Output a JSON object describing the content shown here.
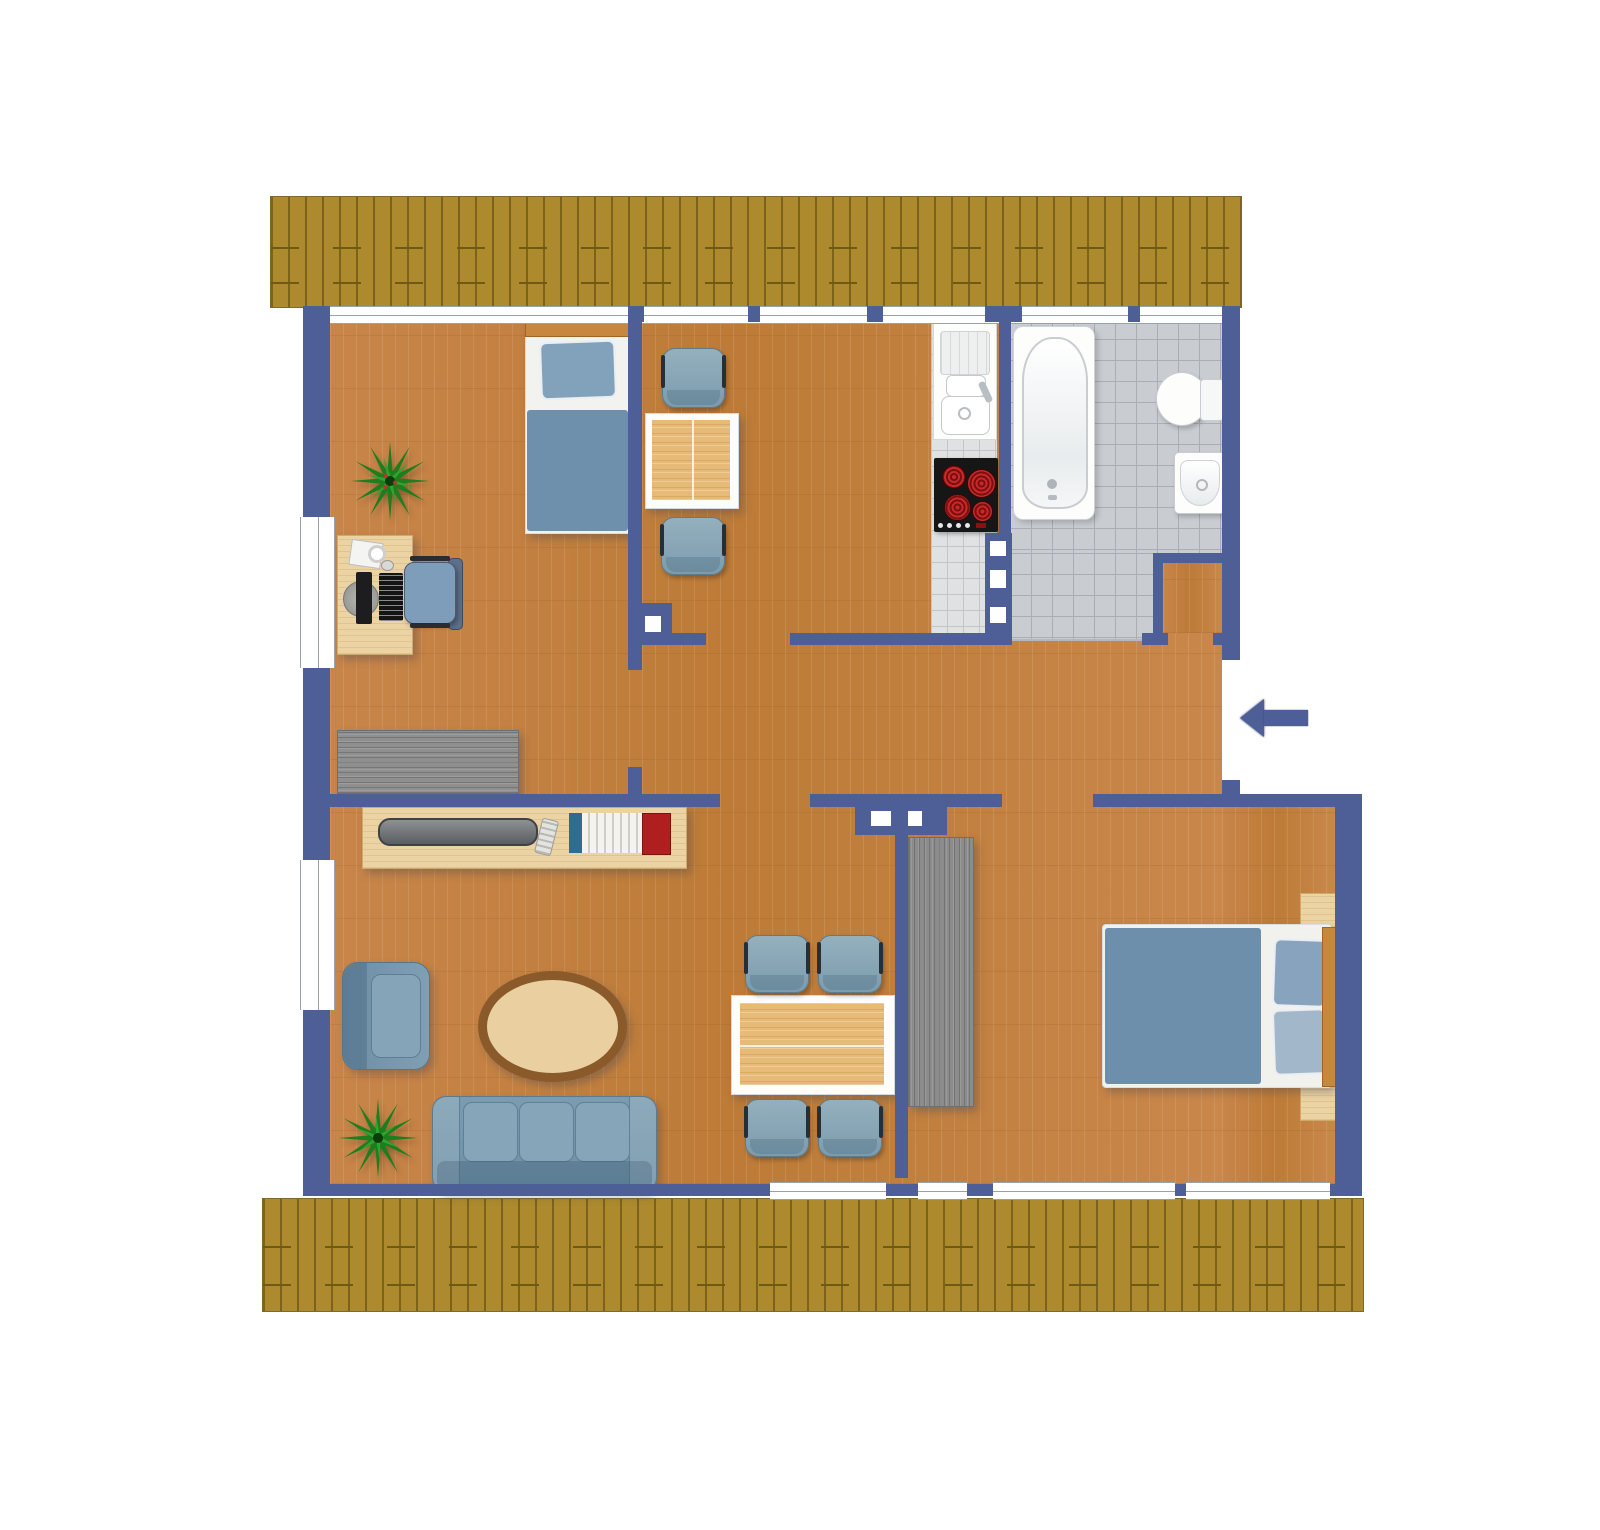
{
  "plan": {
    "type": "apartment-floor-plan",
    "title": "Apartment floor plan",
    "colors": {
      "wall": "#4e5e96",
      "wood_floor": "#c4813f",
      "bathroom_tile": "#c9cdd2",
      "kitchen_tile": "#e0e1e3",
      "roof": "#ad8a2e",
      "furniture_blue": "#7b9cae",
      "table_wood": "#e7bb77",
      "gray_cabinet": "#8c8c8c",
      "accent_red": "#b01f1f",
      "fixture_white": "#fdfdfc"
    },
    "rooms": [
      {
        "id": "bedroom-office",
        "label": "Bedroom / office",
        "furniture": [
          "single bed",
          "plant",
          "desk with computer",
          "office chair",
          "gray sideboard"
        ]
      },
      {
        "id": "kitchen",
        "label": "Kitchen / breakfast nook",
        "furniture": [
          "square table",
          "two chairs",
          "sink unit",
          "cooktop with 4 burners"
        ]
      },
      {
        "id": "bathroom",
        "label": "Bathroom",
        "furniture": [
          "bathtub",
          "toilet",
          "washbasin"
        ]
      },
      {
        "id": "hallway",
        "label": "Hallway",
        "furniture": []
      },
      {
        "id": "living-room",
        "label": "Living room",
        "furniture": [
          "tv bench",
          "flat tv",
          "remote control",
          "book row",
          "armchair",
          "oval coffee table",
          "three-seat sofa",
          "plant"
        ]
      },
      {
        "id": "dining-room",
        "label": "Dining room",
        "furniture": [
          "dining table",
          "four chairs",
          "gray wardrobe"
        ]
      },
      {
        "id": "bedroom",
        "label": "Bedroom",
        "furniture": [
          "double bed",
          "two nightstands"
        ]
      }
    ],
    "entrance": {
      "label": "Entrance",
      "wall": "right",
      "arrow_direction": "left"
    }
  }
}
